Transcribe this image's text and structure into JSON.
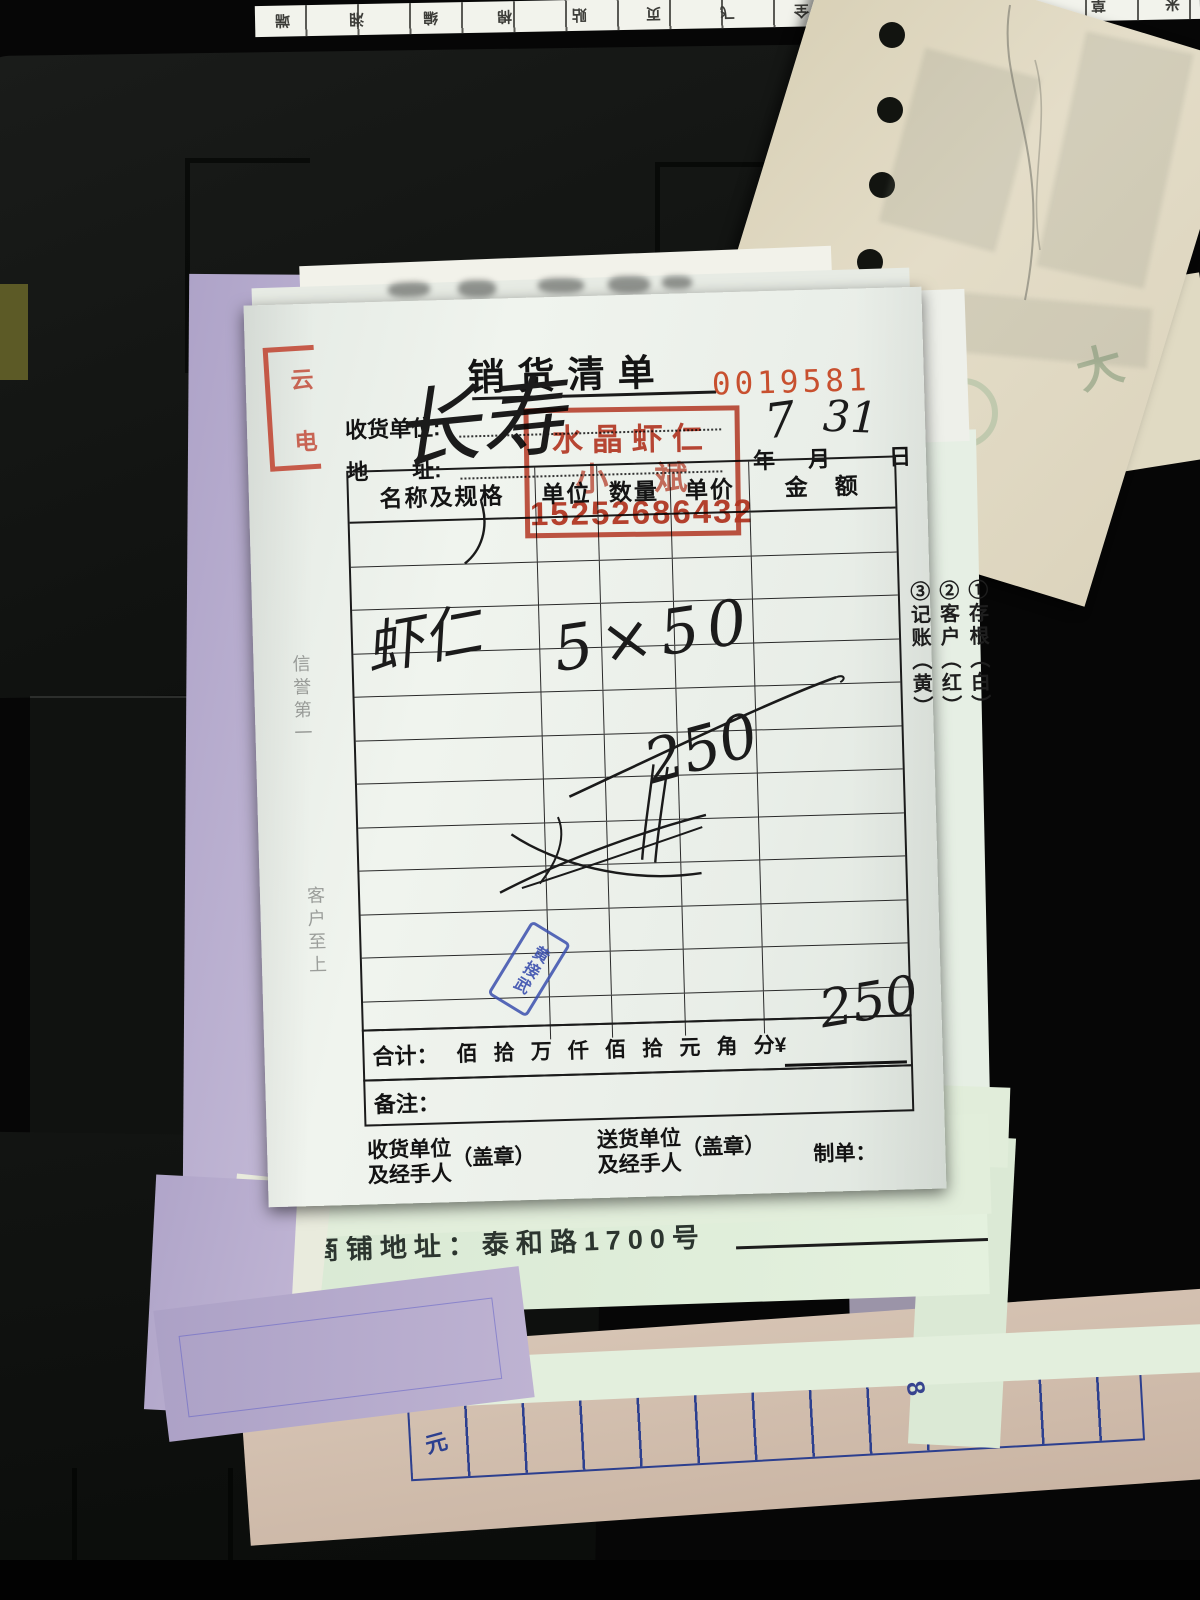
{
  "top_strip": {
    "chars": [
      "端",
      "湘",
      "编",
      "棉",
      "贴",
      "页",
      "飞",
      "全",
      "伟",
      "大",
      "菜",
      "草",
      "米"
    ]
  },
  "beige_note": {
    "faint_char": "大"
  },
  "receipt": {
    "title": "销货清单",
    "serial": "0019581",
    "consignee_label": "收货单位:",
    "address_label": "地　　址:",
    "date": {
      "year": "年",
      "month": "月",
      "day": "日",
      "month_value": "7",
      "day_value": "31"
    },
    "stamp": {
      "line1": "水晶虾仁",
      "name": "小斌",
      "phone": "15252686432"
    },
    "corner_stamp": {
      "char1": "云",
      "char2": "电"
    },
    "handwriting": {
      "consignee": "长寿",
      "item": "虾仁",
      "qty_price": "5×50",
      "amount": "250",
      "total": "250"
    },
    "table": {
      "headers": [
        "名称及规格",
        "单位",
        "数量",
        "单价",
        "金　额"
      ]
    },
    "copies": [
      "①存根（白）",
      "②客户（红）",
      "③记账（黄）"
    ],
    "total": {
      "label": "合计：",
      "units": [
        "佰",
        "拾",
        "万",
        "仟",
        "佰",
        "拾",
        "元",
        "角",
        "分¥"
      ]
    },
    "remarks_label": "备注：",
    "footer": {
      "receiver_l1": "收货单位",
      "receiver_l2": "及经手人",
      "seal": "（盖章）",
      "sender_l1": "送货单位",
      "sender_l2": "及经手人",
      "maker": "制单："
    },
    "mottos": {
      "top": "信誉第一",
      "bottom": "客户至上"
    },
    "blue_stamp": "黄接武",
    "store_address": "商铺地址：泰和路1700号"
  },
  "bottom_sheet": {
    "unit": "元",
    "digit": "8"
  },
  "colors": {
    "stamp_red": "#bf3a26",
    "serial_red": "#c8502f",
    "ink_blue": "#3a4fae",
    "grid_blue": "#2c3f8f"
  }
}
